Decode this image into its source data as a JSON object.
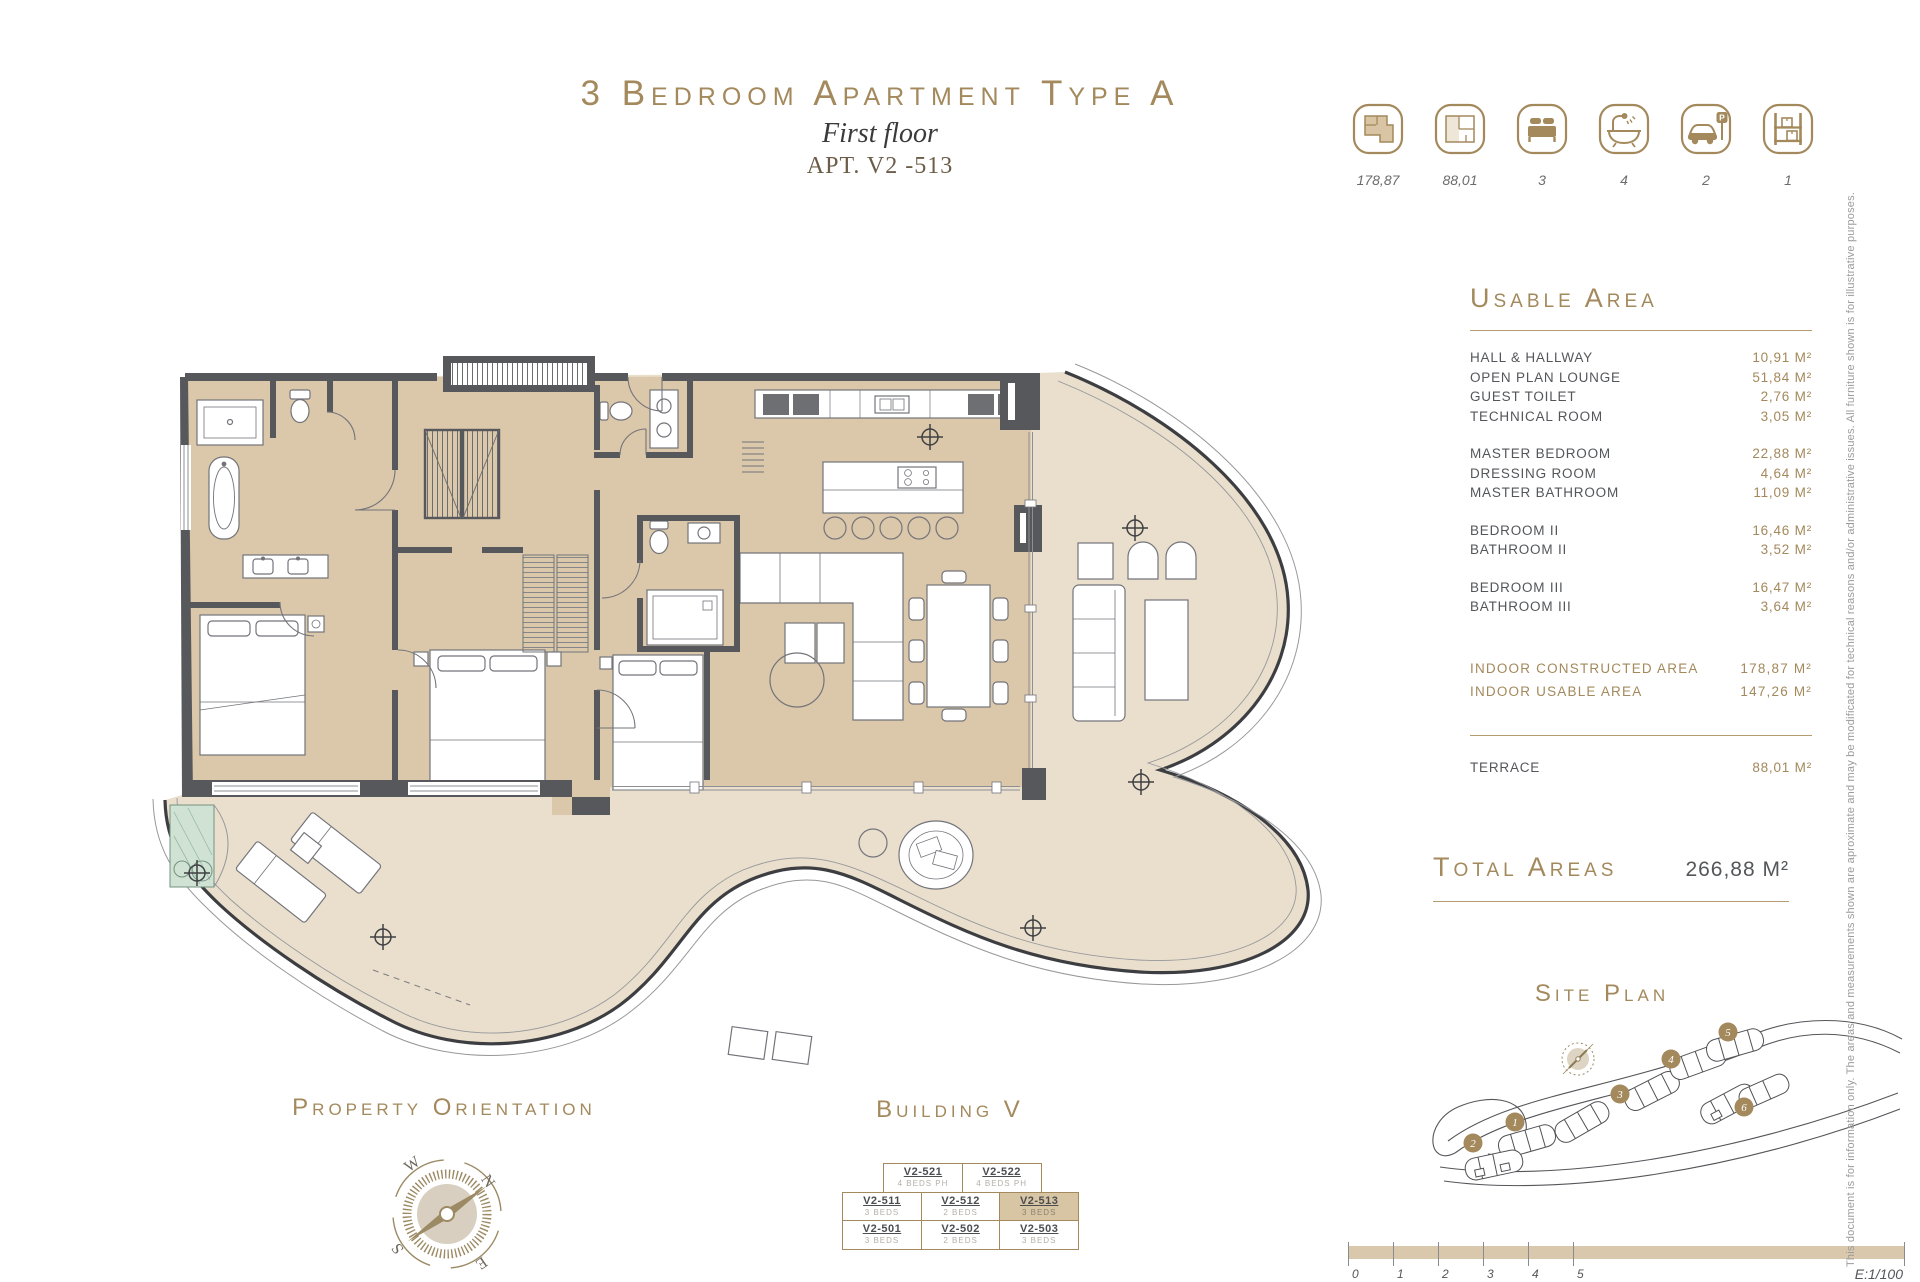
{
  "title": {
    "main": "3 Bedroom Apartment Type A",
    "subtitle": "First floor",
    "apt": "APT. V2 -513"
  },
  "legend": {
    "items": [
      {
        "icon": "indoor-area-plan-icon",
        "value": "178,87"
      },
      {
        "icon": "terrace-area-plan-icon",
        "value": "88,01"
      },
      {
        "icon": "bedrooms-icon",
        "value": "3"
      },
      {
        "icon": "bathrooms-icon",
        "value": "4"
      },
      {
        "icon": "parking-icon",
        "value": "2"
      },
      {
        "icon": "storage-icon",
        "value": "1"
      }
    ]
  },
  "usable_area": {
    "heading": "Usable Area",
    "rows": [
      {
        "label": "HALL & HALLWAY",
        "value": "10,91 M²"
      },
      {
        "label": "OPEN PLAN LOUNGE",
        "value": "51,84 M²"
      },
      {
        "label": "GUEST TOILET",
        "value": "2,76 M²"
      },
      {
        "label": "TECHNICAL ROOM",
        "value": "3,05 M²"
      },
      {
        "label": "MASTER BEDROOM",
        "value": "22,88 M²"
      },
      {
        "label": "DRESSING ROOM",
        "value": "4,64 M²"
      },
      {
        "label": "MASTER BATHROOM",
        "value": "11,09 M²"
      },
      {
        "label": "BEDROOM II",
        "value": "16,46 M²"
      },
      {
        "label": "BATHROOM II",
        "value": "3,52 M²"
      },
      {
        "label": "BEDROOM III",
        "value": "16,47 M²"
      },
      {
        "label": "BATHROOM III",
        "value": "3,64 M²"
      }
    ],
    "summary": [
      {
        "label": "INDOOR CONSTRUCTED AREA",
        "value": "178,87 M²"
      },
      {
        "label": "INDOOR USABLE AREA",
        "value": "147,26 M²"
      }
    ],
    "terrace_row": {
      "label": "TERRACE",
      "value": "88,01 M²"
    }
  },
  "total_areas": {
    "heading": "Total Areas",
    "value": "266,88 M²"
  },
  "site_plan": {
    "heading": "Site Plan",
    "markers": [
      "1",
      "2",
      "3",
      "4",
      "5",
      "6"
    ]
  },
  "orientation": {
    "heading": "Property Orientation",
    "cardinals": {
      "n": "N",
      "s": "S",
      "e": "E",
      "w": "W"
    }
  },
  "building": {
    "heading": "Building V",
    "units": [
      {
        "code": "V2-521",
        "beds": "4 BEDS PH"
      },
      {
        "code": "V2-522",
        "beds": "4 BEDS PH"
      },
      {
        "code": "V2-511",
        "beds": "3 BEDS"
      },
      {
        "code": "V2-512",
        "beds": "2 BEDS"
      },
      {
        "code": "V2-513",
        "beds": "3 BEDS"
      },
      {
        "code": "V2-501",
        "beds": "3 BEDS"
      },
      {
        "code": "V2-502",
        "beds": "2 BEDS"
      },
      {
        "code": "V2-503",
        "beds": "3 BEDS"
      }
    ]
  },
  "scale_bar": {
    "ticks": [
      "0",
      "1",
      "2",
      "3",
      "4",
      "5"
    ],
    "scale": "E:1/100"
  },
  "disclaimer": "This document is for information only. The areas and measurements shown are aproximate and may be modificated for technical reasons and/or administrative issues. All furniture shown is for illustrative purposes.",
  "colors": {
    "accent_gold": "#a3895c",
    "dark_text": "#54565a",
    "wall": "#57585b",
    "interior_floor": "#dbc7a9",
    "terrace_floor": "#eadfcd",
    "highlight_unit": "#d8c5a4",
    "planter_green": "#cfe2d3"
  }
}
